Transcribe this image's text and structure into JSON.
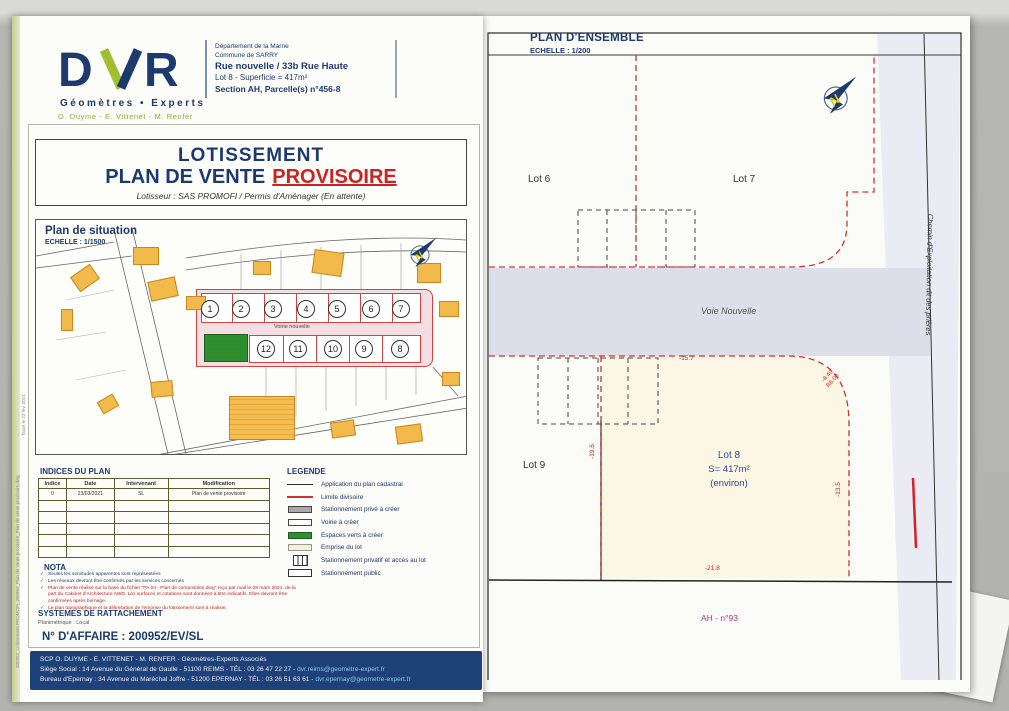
{
  "colors": {
    "navy": "#1d3a6e",
    "red": "#cc2222",
    "logo_green": "#8fae3a",
    "magenta": "#b03090",
    "footer_bg": "#1d4178",
    "road_pink": "#f5dee2",
    "road_lavender": "#dedeea",
    "lot8_cream": "#fbf7e4",
    "building_orange": "#f2b94b",
    "espace_vert_green": "#2f8f2f"
  },
  "left": {
    "logo": {
      "text": "DVR",
      "tagline": "Géomètres • Experts",
      "partners": "O. Duyme - E. Vittenet - M. Renfer"
    },
    "info": {
      "l1": "Département de la Marne",
      "l2": "Commune de SARRY",
      "l3": "Rue nouvelle / 33b Rue Haute",
      "l4": "Lot 8  -  Superficie =  417m²",
      "l5": "Section AH, Parcelle(s) n°456-8"
    },
    "title": {
      "l1": "LOTISSEMENT",
      "l2a": "PLAN DE VENTE",
      "l2b": "PROVISOIRE",
      "sub": "Lotisseur : SAS PROMOFI / Permis d'Aménager (En attente)"
    },
    "situation": {
      "title": "Plan de situation",
      "scale": "ECHELLE : 1/1500",
      "road": "Voirie nouvelle",
      "lots_top": [
        "1",
        "2",
        "3",
        "4",
        "5",
        "6",
        "7"
      ],
      "lots_bottom": [
        "12",
        "11",
        "10",
        "9",
        "8"
      ]
    },
    "indices": {
      "title": "INDICES DU PLAN",
      "headers": [
        "Indice",
        "Date",
        "Intervenant",
        "Modification"
      ],
      "row": [
        "0",
        "23/03/2021",
        "SL",
        "Plan de vente provisoire"
      ]
    },
    "legend": {
      "title": "LEGENDE",
      "items": [
        {
          "symbol": "black-line",
          "label": "Application du plan cadastral"
        },
        {
          "symbol": "red-line",
          "label": "Limite divisoire"
        },
        {
          "symbol": "gray-rect",
          "label": "Stationnement privé à créer"
        },
        {
          "symbol": "white-rect",
          "label": "Voirie à créer"
        },
        {
          "symbol": "green-rect",
          "label": "Espaces verts à créer"
        },
        {
          "symbol": "cream-rect",
          "label": "Emprise du lot"
        },
        {
          "symbol": "bars-rect",
          "label": "Stationnement privatif et accès au lot"
        },
        {
          "symbol": "outline-rect",
          "label": "Stationnement public"
        }
      ]
    },
    "nota": {
      "title": "NOTA",
      "check": "✓",
      "items": [
        {
          "text": "Seules les servitudes apparentes sont représentées",
          "tone": "blue"
        },
        {
          "text": "Les réseaux devront être confirmés par les services concernés",
          "tone": "blue"
        },
        {
          "text": "Plan de vente réalisé sur la base du fichier \"PA 04 - Plan de composition.dwg\" reçu par mail le 08 mars 2021, de la part du Cabinet d'Architecture AWD. Les surfaces et cotations sont données à titre indicatifs. Elles devront être confirmées après bornage.",
          "tone": "red"
        },
        {
          "text": "Le plan topographique et la délimitation de l'emprise du lotissement sont à réaliser.",
          "tone": "red"
        }
      ]
    },
    "rattachement": {
      "title": "SYSTEMES DE RATTACHEMENT",
      "sub": "Planimétrique : Local"
    },
    "affaire": "N° D'AFFAIRE : 200952/EV/SL",
    "footer": {
      "l1": "SCP O. DUYME - E. VITTENET - M. RENFER - Géomètres-Experts Associés",
      "l2": "Siège Social : 14 Avenue du Général de Gaulle - 51100 REIMS - TÉL : 03 26 47 22 27 - ",
      "l2_mail": "dvr.reims@geometre-expert.fr",
      "l3": "Bureau d'Epernay : 34 Avenue du Maréchal Joffre - 51200 EPERNAY - TÉL : 03 26 51 63 61 - ",
      "l3_mail": "dvr.epernay@geometre-expert.fr"
    },
    "stamp": {
      "l1": "200952_Lotissement PROMOFI_200952_Plan de vente provisoire_Plan de vente provisoire.dwg",
      "l2": "Tracé le 23 fév. 2021"
    }
  },
  "right": {
    "title": "PLAN D'ENSEMBLE",
    "scale": "ECHELLE : 1/200",
    "lot6": "Lot 6",
    "lot7": "Lot 7",
    "lot9": "Lot 9",
    "voie": "Voie Nouvelle",
    "lot8": {
      "l1": "Lot 8",
      "l2": "S= 417m²",
      "l3": "(environ)"
    },
    "chemin": "Chemin d'Exploitation dit des prières",
    "section": "AH - n°93",
    "dims": {
      "top": "-15.7",
      "arc1": "-8.49",
      "arc2": "R6.00",
      "right": "-13.5",
      "left": "-19.6",
      "bottom": "-21.8"
    },
    "north": "N"
  }
}
